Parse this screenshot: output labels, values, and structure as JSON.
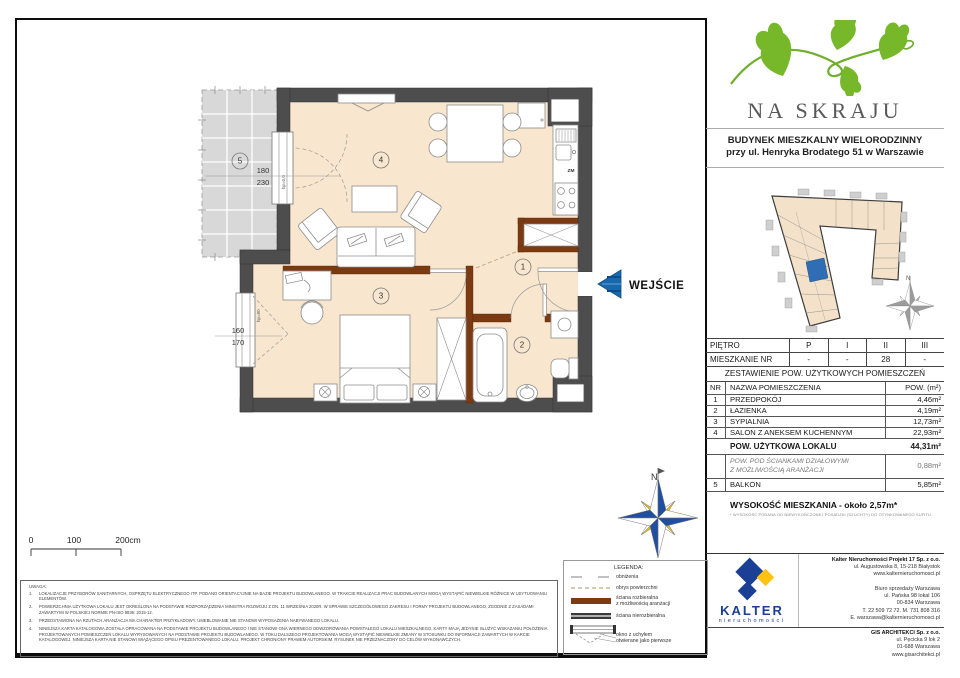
{
  "header": {
    "project_name": "NA SKRAJU",
    "building_line1": "BUDYNEK MIESZKALNY WIELORODZINNY",
    "building_line2": "przy ul. Henryka Brodatego 51 w Warszawie"
  },
  "floor_table": {
    "row1_label": "PIĘTRO",
    "row2_label": "MIESZKANIE NR",
    "floors": [
      "P",
      "I",
      "II",
      "III"
    ],
    "apartments": [
      "-",
      "-",
      "28",
      "-"
    ]
  },
  "areas": {
    "title": "ZESTAWIENIE POW. UŻYTKOWYCH POMIESZCZEŃ",
    "col_nr": "NR",
    "col_name": "NAZWA POMIESZCZENIA",
    "col_area": "POW. (m²)",
    "rows": [
      {
        "nr": "1",
        "name": "PRZEDPOKÓJ",
        "area": "4,46m²"
      },
      {
        "nr": "2",
        "name": "ŁAZIENKA",
        "area": "4,19m²"
      },
      {
        "nr": "3",
        "name": "SYPIALNIA",
        "area": "12,73m²"
      },
      {
        "nr": "4",
        "name": "SALON Z ANEKSEM KUCHENNYM",
        "area": "22,93m²"
      }
    ],
    "total_label": "POW. UŻYTKOWA LOKALU",
    "total_area": "44,31m²",
    "partition_label1": "POW. POD ŚCIANKAMI DZIAŁOWYMI",
    "partition_label2": "Z MOŻLIWOŚCIĄ ARANŻACJI",
    "partition_area": "0,88m²",
    "balcony_nr": "5",
    "balcony_label": "BALKON",
    "balcony_area": "5,85m²"
  },
  "height_info": {
    "label": "WYSOKOŚĆ MIESZKANIA - około 2,57m*",
    "footnote": "* WYSOKOŚĆ PODANA OD NIEWYKOŃCZONEJ POSADZKI (SZLICHTY) DO OTYNKOWANEGO SUFITU"
  },
  "plan": {
    "rooms": {
      "r1": "1",
      "r2": "2",
      "r3": "3",
      "r4": "4",
      "r5": "5"
    },
    "dims": {
      "balcony_w": "180",
      "balcony_h": "230",
      "bedroom_w": "160",
      "bedroom_h": "170",
      "hp_balcony": "hp=0,0",
      "hp_bedroom": "hp=80"
    },
    "kitchen_zm": "ZM",
    "entrance_label": "WEJŚCIE",
    "compass_n": "N"
  },
  "scalebar": {
    "t0": "0",
    "t100": "100",
    "t200": "200cm"
  },
  "legend": {
    "title": "LEGENDA:",
    "item1": "obniżenia",
    "item2": "obrys powierzchni",
    "item3a": "ściana rozbieralna",
    "item3b": "z możliwością aranżacji",
    "item4": "ściana nierozbieralna",
    "item5a": "okno z uchyłem",
    "item5b": "otwierane jako pierwsze"
  },
  "notes": {
    "title": "UWAGA:",
    "items": [
      {
        "num": "1.",
        "text": "LOKALIZACJE PRZYBORÓW SANITARNYCH, OSPRZĘTU ELEKTRYCZNEGO ITP. PODANO ORIENTACYJNIE NA BAZIE PROJEKTU BUDOWLANEGO. W TRAKCIE REALIZACJI PRAC BUDOWLANYCH MOGĄ WYSTĄPIĆ NIEWIELKIE RÓŻNICE W USYTUOWANIU ELEMENTÓW."
      },
      {
        "num": "2.",
        "text": "POWIERZCHNIA UŻYTKOWA LOKALU JEST OKREŚLONA NA PODSTAWIE ROZPORZĄDZENIA MINISTRA ROZWOJU Z DN. 11 WRZEŚNIA 2020R. W SPRAWIE SZCZEGÓŁOWEGO ZAKRESU I FORMY PROJEKTU BUDOWLANEGO, ZGODNIE Z ZASADAMI ZAWARTYMI W POLSKIEJ NORMIE PN-ISO 9836: 2015-12."
      },
      {
        "num": "3.",
        "text": "PRZEDSTAWIONA NA RZUTACH ARANŻACJA MA CHARAKTER PRZYKŁADOWY. UMEBLOWANIE NIE STANOWI WYPOSAŻENIA NABYWANEGO LOKALU."
      },
      {
        "num": "4.",
        "text": "NINIEJSZA KARTA KATALOGOWA ZOSTAŁA OPRACOWANA NA PODSTAWIE PROJEKTU BUDOWLANEGO I NIE STANOWI ONA WIERNEGO ODWZOROWANIA POWSTAŁEGO LOKALU MIESZKALNEGO. KARTY MAJĄ JEDYNIE SŁUŻYĆ WSKAZANIU POŁOŻENIA PROJEKTOWANYCH POMIESZCZEŃ LOKALU WYRYSOWANYCH NA PODSTAWIE PROJEKTU BUDOWLANEGO. W TOKU DALSZEGO PROJEKTOWANIA MOGĄ WYSTĄPIĆ NIEWIELKIE ZMIANY W STOSUNKU DO INFORMACJI ZAWARTYCH W KARCIE KATALOGOWEJ. NINIEJSZA KARTA NIE STANOWI WIĄŻĄCEGO OPISU PREZENTOWANEGO LOKALU. PROJEKT CHRONIONY PRAWEM AUTORSKIM. RYSUNEK NIE PRZEZNACZONY DO CELÓW WYKONAWCZYCH."
      }
    ]
  },
  "footer": {
    "kalter_name": "KALTER",
    "kalter_sub": "nieruchomości",
    "company1": [
      "Kalter Nieruchomości Projekt 17 Sp. z o.o.",
      "ul. Augustowska 8, 15-218 Białystok",
      "www.kalternieruchomosci.pl"
    ],
    "company2": [
      "Biuro sprzedaży Warszawa",
      "ul. Pańska 98 lokal 106",
      "00-834 Warszawa",
      "T. 22 509 72 72. M. 731 808 316",
      "E. warszawa@kalternieruchomosci.pl"
    ],
    "company3": [
      "GIS ARCHITEKCI Sp. z o.o.",
      "ul. Pęcicka 9 lok 2",
      "01-688 Warszawa",
      "www.gisarchitekci.pl"
    ]
  },
  "colors": {
    "entrance_arrow_blue": "#1868ad",
    "kalter_navy": "#1b3f94",
    "kalter_yellow": "#ffc20e",
    "logo_green": "#76b82a",
    "wall_dark": "#4d4d4d",
    "wall_removable_brown": "#7b3a12",
    "floor_peach": "#f8e6cf",
    "siteplan_highlight_blue": "#2f6eb4"
  }
}
